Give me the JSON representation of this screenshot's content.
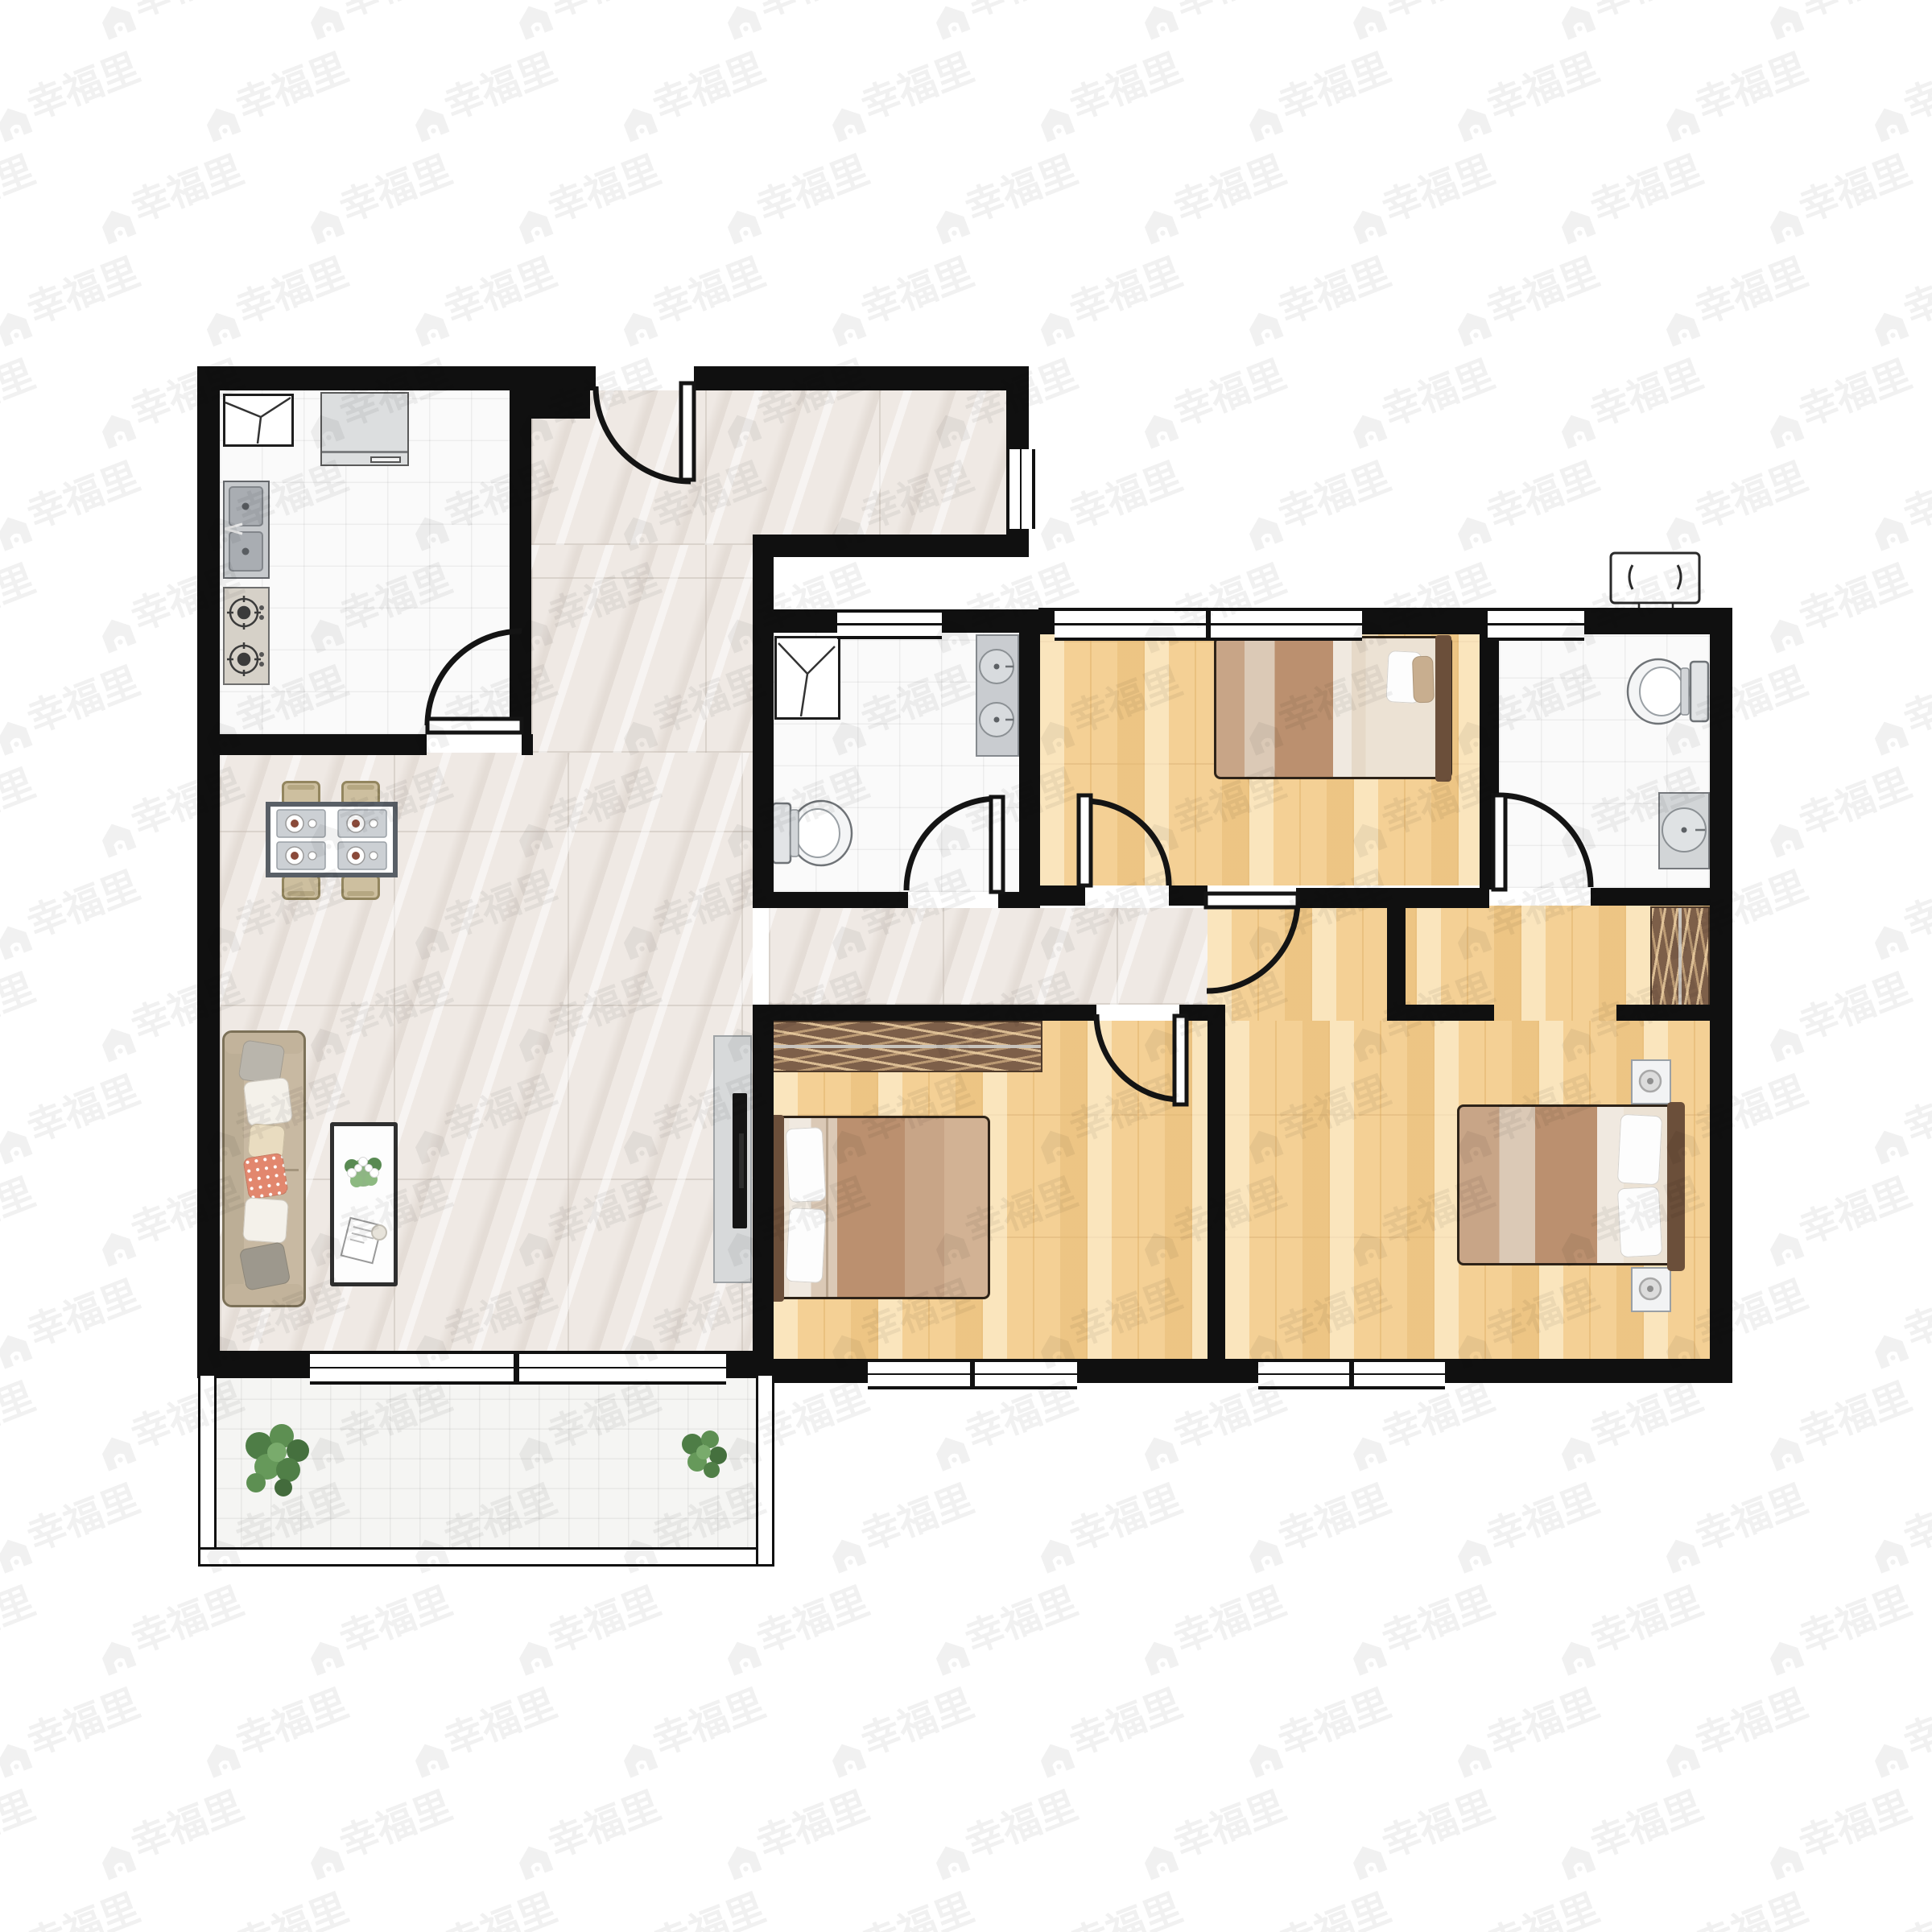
{
  "watermark": {
    "text": "幸福里",
    "color": "#000000",
    "opacity": 0.055
  },
  "palette": {
    "wall": "#101010",
    "wood_floor": "#f4d095",
    "marble_floor": "#efe9e4",
    "white_tile": "#fafafa",
    "balcony_tile": "#f5f5f3",
    "wardrobe_brown": "#7d5f49",
    "bed_headboard": "#6b4f3a",
    "blanket_tan": "#bb906f",
    "sofa_beige": "#c8b9a2",
    "fixture_gray": "#c9ccd0",
    "plant_green": "#55854d",
    "accent_pillow_orange": "#e2876e"
  },
  "rooms": [
    {
      "name": "kitchen",
      "floor": "white-tile",
      "furniture": [
        "fridge",
        "counter-cabinet",
        "double-basin-sink",
        "gas-stove"
      ]
    },
    {
      "name": "entry-hall",
      "floor": "marble",
      "furniture": []
    },
    {
      "name": "living-dining-room",
      "floor": "marble",
      "furniture": [
        "dining-table",
        "dining-chair",
        "dining-chair",
        "dining-chair",
        "dining-chair",
        "sofa",
        "coffee-table",
        "tv-panel"
      ]
    },
    {
      "name": "bathroom-main",
      "floor": "white-tile",
      "furniture": [
        "washing-machine",
        "double-vanity",
        "toilet"
      ]
    },
    {
      "name": "bedroom-north",
      "floor": "wood",
      "furniture": [
        "double-bed"
      ]
    },
    {
      "name": "bathroom-ensuite",
      "floor": "white-tile",
      "furniture": [
        "toilet",
        "wash-basin"
      ]
    },
    {
      "name": "bedroom-middle",
      "floor": "wood",
      "furniture": [
        "wardrobe",
        "double-bed"
      ]
    },
    {
      "name": "bedroom-master",
      "floor": "wood",
      "furniture": [
        "wardrobe",
        "double-bed",
        "nightstand",
        "nightstand"
      ]
    },
    {
      "name": "balcony",
      "floor": "tile",
      "furniture": [
        "potted-plant",
        "potted-plant"
      ]
    }
  ],
  "exterior_equipment": [
    "air-conditioner-outdoor-unit"
  ],
  "counts": {
    "bedrooms": 3,
    "bathrooms": 2,
    "balconies": 1,
    "swing_doors": 7,
    "windows": 7
  }
}
